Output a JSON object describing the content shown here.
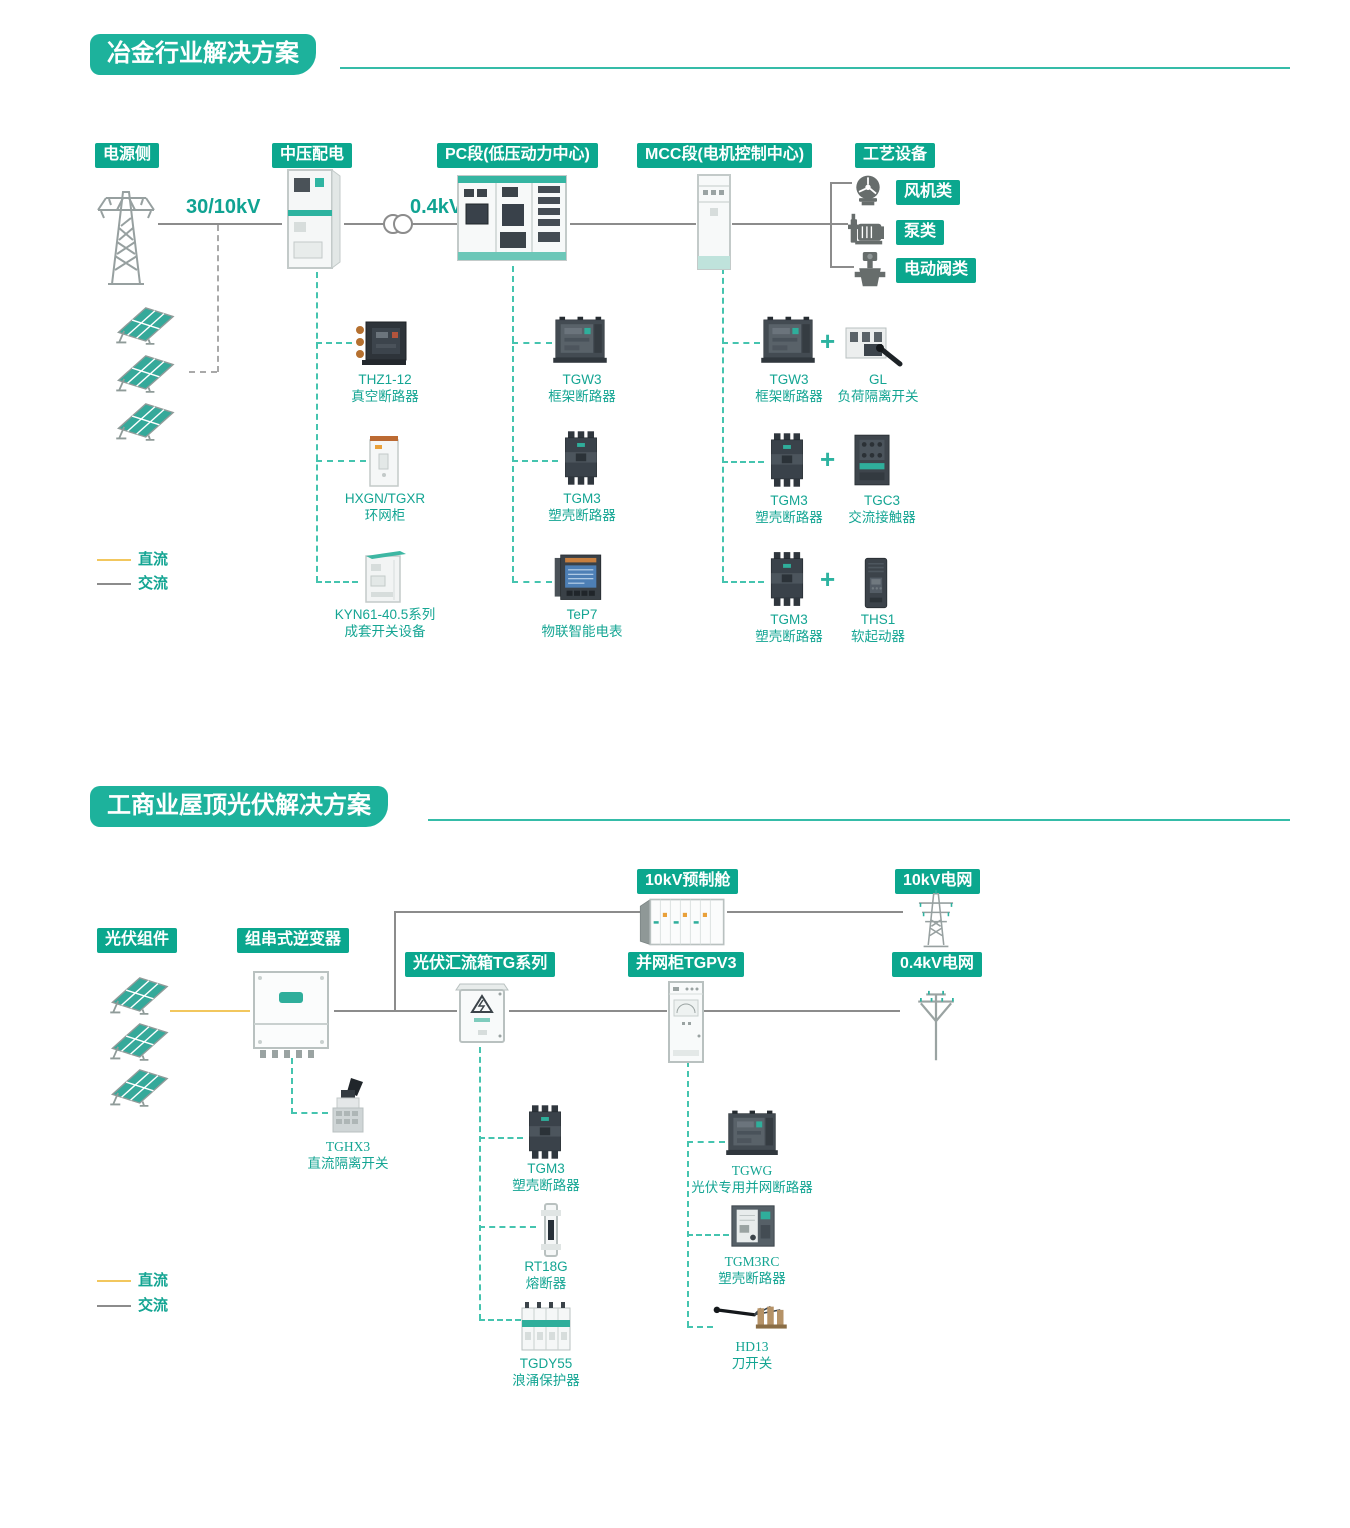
{
  "colors": {
    "teal_badge": "#0ba78e",
    "teal_title": "#1db29c",
    "teal_text": "#14a593",
    "dashed_teal": "#45c4af",
    "line_gray": "#8c8c8c",
    "dc_yellow": "#f2c75e"
  },
  "section1": {
    "title": "冶金行业解决方案",
    "labels": {
      "power_side": "电源侧",
      "mv_dist": "中压配电",
      "pc_section": "PC段(低压动力中心)",
      "mcc_section": "MCC段(电机控制中心)",
      "process_equipment": "工艺设备"
    },
    "voltages": {
      "incoming": "30/10kV",
      "lv": "0.4kV"
    },
    "process_loads": [
      {
        "label": "风机类"
      },
      {
        "label": "泵类"
      },
      {
        "label": "电动阀类"
      }
    ],
    "mv_products": [
      {
        "name": "THZ1-12",
        "desc": "真空断路器"
      },
      {
        "name": "HXGN/TGXR",
        "desc": "环网柜"
      },
      {
        "name": "KYN61-40.5系列",
        "desc": "成套开关设备"
      }
    ],
    "pc_products": [
      {
        "name": "TGW3",
        "desc": "框架断路器"
      },
      {
        "name": "TGM3",
        "desc": "塑壳断路器"
      },
      {
        "name": "TeP7",
        "desc": "物联智能电表"
      }
    ],
    "mcc_pairs": [
      {
        "a": {
          "name": "TGW3",
          "desc": "框架断路器"
        },
        "plus": "+",
        "b": {
          "name": "GL",
          "desc": "负荷隔离开关"
        }
      },
      {
        "a": {
          "name": "TGM3",
          "desc": "塑壳断路器"
        },
        "plus": "+",
        "b": {
          "name": "TGC3",
          "desc": "交流接触器"
        }
      },
      {
        "a": {
          "name": "TGM3",
          "desc": "塑壳断路器"
        },
        "plus": "+",
        "b": {
          "name": "THS1",
          "desc": "软起动器"
        }
      }
    ],
    "legend": {
      "dc": "直流",
      "ac": "交流"
    }
  },
  "section2": {
    "title": "工商业屋顶光伏解决方案",
    "labels": {
      "pv_modules": "光伏组件",
      "inverter": "组串式逆变器",
      "combiner": "光伏汇流箱TG系列",
      "grid_cabinet": "并网柜TGPV3",
      "cabin": "10kV预制舱",
      "grid_10kv": "10kV电网",
      "grid_04kv": "0.4kV电网"
    },
    "inverter_product": {
      "name": "TGHX3",
      "desc": "直流隔离开关"
    },
    "combiner_products": [
      {
        "name": "TGM3",
        "desc": "塑壳断路器"
      },
      {
        "name": "RT18G",
        "desc": "熔断器"
      },
      {
        "name": "TGDY55",
        "desc": "浪涌保护器"
      }
    ],
    "grid_cabinet_products": [
      {
        "name": "TGWG",
        "desc": "光伏专用并网断路器"
      },
      {
        "name": "TGM3RC",
        "desc": "塑壳断路器"
      },
      {
        "name": "HD13",
        "desc": "刀开关"
      }
    ],
    "legend": {
      "dc": "直流",
      "ac": "交流"
    }
  }
}
